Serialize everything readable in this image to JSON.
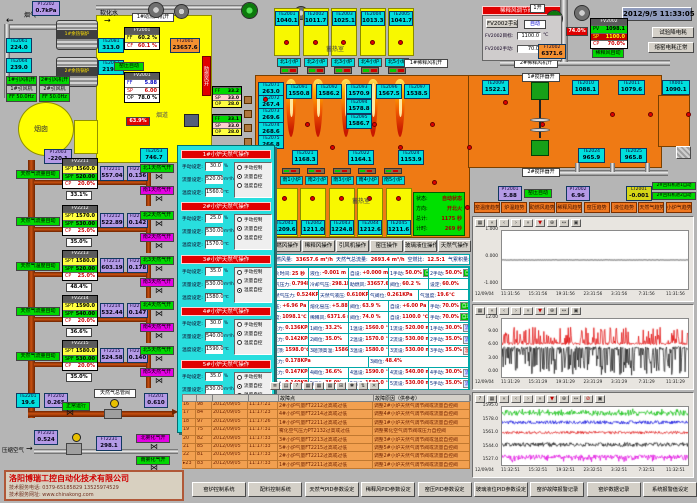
{
  "datetime": "2012/9/5 11:33:05",
  "topLeft": {
    "flueGas": "烟气",
    "softWater": "软化水",
    "duct": "烟道",
    "chimney": "烟囱",
    "airOn": "助燃风开",
    "fanLabel": "1#助燃风机开",
    "kilnAuto": "窑压自动",
    "damper": "63.9%",
    "pt2202": [
      "PT2202",
      "0.7kPa"
    ],
    "pt2003": [
      "PT2003",
      "-220.1"
    ],
    "te2053": [
      "TE2053",
      "746.7"
    ],
    "ft2001": [
      "FT2001",
      "23657.6"
    ],
    "boilers": [
      "1#余热锅炉",
      "2#余热锅炉"
    ],
    "sensors": [
      [
        "TE2061",
        "224.0"
      ],
      [
        "TE2064",
        "239.0"
      ],
      [
        "TE2081",
        "313.0"
      ],
      [
        "TE2063",
        "219.0"
      ]
    ],
    "fanOn": [
      "1#引风机开",
      "2#引风机开"
    ],
    "fans": [
      [
        "1#引风机",
        "FF 50.0Hz"
      ],
      [
        "2#引风机",
        "FF 50.0Hz"
      ]
    ],
    "fy2001": {
      "title": "FY2001",
      "rows": [
        [
          "FF",
          "60.2 %"
        ],
        [
          "CF",
          "60.1 %"
        ]
      ]
    },
    "fv2001": {
      "title": "FV2001",
      "rows": [
        [
          "FF",
          "5.88"
        ],
        [
          "SP",
          "6.00"
        ],
        [
          "OP",
          "78.0 %"
        ]
      ]
    },
    "feeders": [
      {
        "rows": [
          [
            "FF",
            "33.2"
          ],
          [
            "SP",
            "33.0"
          ],
          [
            "OP",
            "28.0"
          ]
        ]
      },
      {
        "rows": [
          [
            "FF",
            "33.1"
          ],
          [
            "SP",
            "33.0"
          ],
          [
            "OP",
            "28.0"
          ]
        ]
      }
    ]
  },
  "regen": {
    "label": "蓄热室",
    "north": [
      [
        "TE2001",
        "1040.1"
      ],
      [
        "TE2002",
        "1011.7"
      ],
      [
        "TE2003",
        "1025.1"
      ],
      [
        "TE2004",
        "1013.3"
      ],
      [
        "TE2005",
        "1041.7"
      ]
    ],
    "burnersN": [
      "北1小炉",
      "北2小炉",
      "北3小炉",
      "北4小炉",
      "北5小炉"
    ],
    "burnersS": [
      "南1小炉",
      "南2小炉",
      "南3小炉",
      "南4小炉",
      "南5小炉"
    ],
    "south": [
      [
        "TE2041",
        "1209.6"
      ],
      [
        "TE2042",
        "1211.0"
      ],
      [
        "TE2043",
        "1224.8"
      ],
      [
        "TE2044",
        "1212.6"
      ],
      [
        "TE2045",
        "1211.6"
      ]
    ]
  },
  "furnace": {
    "leftCol": [
      [
        "TE2071",
        "263.0"
      ],
      [
        "TE2072",
        "267.4"
      ],
      [
        "TE2073",
        "269.6"
      ],
      [
        "TE2074",
        "268.6"
      ],
      [
        "TE2075",
        "266.8"
      ]
    ],
    "topRow": [
      [
        "TE2091",
        "1550.8"
      ],
      [
        "TE2092",
        "1586.2"
      ],
      [
        "TE2093",
        "1570.9"
      ],
      [
        "TE2096",
        "1567.5"
      ],
      [
        "TE2097",
        "1538.5"
      ]
    ],
    "midStack": [
      [
        "TE2094",
        "1578.8"
      ],
      [
        "TE2095",
        "1586.7"
      ]
    ],
    "bottomRow": [
      [
        "TE2021",
        "1168.3"
      ],
      [
        "TE2022",
        "1164.1"
      ],
      [
        "TE2024",
        "1153.9"
      ]
    ],
    "rightTop": [
      [
        "TE2009",
        "1522.1"
      ],
      [
        "TE2010",
        "1088.1"
      ],
      [
        "TE2011",
        "1079.6"
      ],
      [
        "TX001",
        "1090.1"
      ]
    ],
    "rightBottom": [
      [
        "TE2024",
        "965.9"
      ],
      [
        "TE2025",
        "965.8"
      ]
    ],
    "stirrer1": "1#搅拌器开",
    "stirrer2": "2#搅拌器开",
    "fan1": "1#稀释风机开",
    "fan2": "2#稀释风机开",
    "open1": "1开"
  },
  "fire": {
    "button": "开北火",
    "status": [
      [
        "状态:",
        "自动状态"
      ],
      [
        "方向:",
        "开北火"
      ],
      [
        "总计:",
        "1175 秒"
      ],
      [
        "计时:",
        "269 秒"
      ]
    ]
  },
  "opButtons": [
    "助燃风操作",
    "稀释风操作",
    "引风机操作",
    "窑压操作",
    "玻璃液位操作",
    "天然气操作"
  ],
  "dilution": {
    "title": "稀释风调节阀操作",
    "manualBtn": "FV2002手动",
    "autoLabel": "自动",
    "target": {
      "l": "FV2002目标:",
      "v": "1100.0",
      "u": "℃"
    },
    "manual": {
      "l": "FV2002手动:",
      "v": "70.0",
      "u": "%"
    },
    "fv2002": {
      "title": "FV2002",
      "rows": [
        [
          "PV",
          "1098.1"
        ],
        [
          "SP",
          "1100.0"
        ],
        [
          "CP",
          "70.0%"
        ]
      ]
    },
    "autoTag": "稀释风自动",
    "pct": "74.0%",
    "ft2002": [
      "FT2002",
      "6371.6"
    ],
    "btn1": "试验降电耗",
    "btn2": "熔窑电耗正常"
  },
  "gasLoops": [
    {
      "auto": "天然气流量自动",
      "ctrl": "FV2211",
      "spt": "1560.0",
      "spf": "520.00",
      "cp": "20.0%",
      "pos": "33.1%",
      "ft": [
        "FT2211",
        "557.04"
      ],
      "fi": [
        "FI2211",
        "0.136"
      ],
      "vN": "北1天然气开",
      "vS": "南1天然气开"
    },
    {
      "auto": "天然气流量自动",
      "ctrl": "FV2212",
      "spt": "1570.0",
      "spf": "530.00",
      "cp": "25.0%",
      "pos": "35.0%",
      "ft": [
        "FT2212",
        "522.89"
      ],
      "fi": [
        "FI2212",
        "0.142"
      ],
      "vN": "北2天然气开",
      "vS": "南2天然气开"
    },
    {
      "auto": "天然气温度自动",
      "ctrl": "FV2213",
      "spt": "1580.0",
      "spf": "520.00",
      "cp": "25.0%",
      "pos": "48.4%",
      "ft": [
        "FT2213",
        "603.19"
      ],
      "fi": [
        "FI2213",
        "0.178"
      ],
      "vN": "北3天然气开",
      "vS": "南3天然气开"
    },
    {
      "auto": "天然气流量自动",
      "ctrl": "FV2214",
      "spt": "1590.0",
      "spf": "540.00",
      "cp": "20.0%",
      "pos": "36.6%",
      "ft": [
        "FT2214",
        "532.44"
      ],
      "fi": [
        "FI2214",
        "0.147"
      ],
      "vN": "北4天然气开",
      "vS": "南4天然气开"
    },
    {
      "auto": "天然气流量自动",
      "ctrl": "FV2215",
      "spt": "1580.0",
      "spf": "530.00",
      "cp": "20.0%",
      "pos": "35.0%",
      "ft": [
        "FT2215",
        "524.58"
      ],
      "fi": [
        "FI2215",
        "0.140"
      ],
      "vN": "北5天然气开",
      "vS": "南5天然气开"
    }
  ],
  "gasMain": {
    "te": [
      "TE2201",
      "19.6"
    ],
    "pt": [
      "PT2202",
      "0.265"
    ],
    "run": "正常运行",
    "valveLabel": "天然气总管阀",
    "fi": [
      "FI2201",
      "0.610"
    ]
  },
  "airLine": {
    "label": "压缩空气",
    "pt": [
      "PT2321",
      "0.524"
    ],
    "ft": [
      "FT2231",
      "298.1"
    ],
    "vN": "北雾化气开",
    "vS": "南雾化气开"
  },
  "popup": {
    "fieldLabels": [
      "手动设定:",
      "流量设定:",
      "温度设定:"
    ],
    "units": [
      "%",
      "m³/h",
      "℃"
    ],
    "radioLabels": [
      "手动控制",
      "流量自控",
      "温度自控"
    ],
    "sections": [
      {
        "title": "1#小炉天然气操作",
        "manual": "30.0",
        "flow": "520.00",
        "temp": "1560.0",
        "sel": 1
      },
      {
        "title": "2#小炉天然气操作",
        "manual": "25.0",
        "flow": "530.00",
        "temp": "1570.0",
        "sel": 1
      },
      {
        "title": "3#小炉天然气操作",
        "manual": "35.0",
        "flow": "530.00",
        "temp": "1580.0",
        "sel": 2
      },
      {
        "title": "4#小炉天然气操作",
        "manual": "30.0",
        "flow": "540.00",
        "temp": "1590.0",
        "sel": 1
      },
      {
        "title": "5#小炉天然气操作",
        "manual": "35.0",
        "flow": "530.00",
        "temp": "1580.0",
        "sel": 1
      }
    ]
  },
  "statusBar": [
    [
      "助燃风量:",
      "33657.6 m³/h"
    ],
    [
      "天然气总流量:",
      "2693.4 m³/h"
    ],
    [
      "空燃比:",
      "12.5:1"
    ],
    [
      "气累积量:",
      "134057.7m³"
    ]
  ],
  "midTable": [
    {
      "cells": [
        {
          "l": "换火时间:",
          "v": "25 秒"
        },
        {
          "l": "液位:",
          "v": "-0.001 m"
        },
        {
          "l": "自设:",
          "v": "+0.000 m"
        },
        {
          "l": "1手动:",
          "v": "50.0%",
          "b": "自动"
        },
        {
          "l": "2手动:",
          "v": "50.0%",
          "b": "自动"
        }
      ]
    },
    {
      "cells": [
        {
          "l": "煤气压力:",
          "v": "0.794KPa"
        },
        {
          "l": "冷却气压:",
          "v": "298.1KPa"
        },
        {
          "l": "助燃风:",
          "v": "33657.6 m³/h"
        },
        {
          "l": "阀位:",
          "v": "60.2 %"
        },
        {
          "l": "设定:",
          "v": "60.0%"
        }
      ]
    },
    {
      "cells": [
        {
          "l": "天然气压力:",
          "v": "0.524KPa"
        },
        {
          "l": "天然气液压:",
          "v": "0.610KPa"
        },
        {
          "l": "气阀位:",
          "v": "0.261KPa"
        },
        {
          "l": "气温度:",
          "v": "19.6℃"
        }
      ]
    },
    {
      "cells": [
        {
          "l": "窑压:",
          "v": "+6.96 Pa"
        },
        {
          "l": "熔化窑压:",
          "v": "+5.88 Pa"
        },
        {
          "l": "阀位:",
          "v": "63.9 %"
        },
        {
          "l": "自设:",
          "v": "+6.00 Pa"
        },
        {
          "l": "手动:",
          "v": "70.0%",
          "b": "自动"
        }
      ]
    },
    {
      "cells": [
        {
          "l": "温度:",
          "v": "1098.1℃"
        },
        {
          "l": "稀释风:",
          "v": "6371.6 m³/h"
        },
        {
          "l": "阀位:",
          "v": "74.0 %"
        },
        {
          "l": "自设:",
          "v": "1100.0 ℃"
        },
        {
          "l": "手动:",
          "v": "70.0%",
          "b": "自动"
        }
      ]
    },
    {
      "cells": [
        {
          "l": "1压力:",
          "v": "0.136KPa"
        },
        {
          "l": "1阀位:",
          "v": "33.2%"
        },
        {
          "l": "1温设:",
          "v": "1560.0 ℃"
        },
        {
          "l": "1流设:",
          "v": "520.00 m³/h"
        },
        {
          "l": "1手动:",
          "v": "30.0%",
          "b": "流控"
        }
      ]
    },
    {
      "cells": [
        {
          "l": "2压力:",
          "v": "0.142KPa"
        },
        {
          "l": "2阀位:",
          "v": "35.0%"
        },
        {
          "l": "2温设:",
          "v": "1570.0 ℃"
        },
        {
          "l": "2流设:",
          "v": "530.00 m³/h"
        },
        {
          "l": "2手动:",
          "v": "35.0%",
          "b": "流控"
        }
      ]
    },
    {
      "cells": [
        {
          "l": "3碹顶:",
          "v": "1598.0℃"
        },
        {
          "l": "3碹顶高温:",
          "v": "1586.7℃"
        },
        {
          "l": "3温设:",
          "v": "1580.0 ℃"
        },
        {
          "l": "3流设:",
          "v": "530.00 m³/h"
        },
        {
          "l": "3手动:",
          "v": "35.0%",
          "b": "温控"
        }
      ]
    },
    {
      "cells": [
        {
          "l": "3压力:",
          "v": "0.178KPa"
        },
        {
          "l": "3阀位:",
          "v": "48.4%"
        }
      ]
    },
    {
      "cells": [
        {
          "l": "4压力:",
          "v": "0.147KPa"
        },
        {
          "l": "4阀位:",
          "v": "36.6%"
        },
        {
          "l": "4温设:",
          "v": "1590.0 ℃"
        },
        {
          "l": "4流设:",
          "v": "540.00 m³/h"
        },
        {
          "l": "4手动:",
          "v": "30.0%",
          "b": "流控"
        }
      ]
    },
    {
      "cells": [
        {
          "l": "5压力:",
          "v": "0.140KPa"
        },
        {
          "l": "5阀位:",
          "v": "35.0%"
        },
        {
          "l": "5温设:",
          "v": "1580.0 ℃"
        },
        {
          "l": "5流设:",
          "v": "530.00 m³/h"
        },
        {
          "l": "5手动:",
          "v": "35.0%",
          "b": "流控"
        }
      ]
    }
  ],
  "kilnBoxes": {
    "pt2001": [
      "PT2001",
      "5.88"
    ],
    "auto": "窑压自动",
    "pt2002": [
      "PT2002",
      "6.96"
    ],
    "lt2001": [
      "LT2001",
      "-0.001"
    ],
    "feed": [
      "2#回料机进1自动",
      "2#回料机进2自动"
    ]
  },
  "trendButtons": [
    "窑温度趋势",
    "炉温趋势",
    "助燃风趋势",
    "稀释风趋势",
    "窑压趋势",
    "液位趋势",
    "天然气趋势",
    "小炉气趋势"
  ],
  "chart_data": [
    {
      "type": "line",
      "yLabels": [
        "1.000",
        "0.000",
        "-1.000"
      ],
      "ymin": -1,
      "ymax": 1,
      "xDate": "12/09/04",
      "xLabels": [
        "11:31:56",
        "15:31:56",
        "19:31:56",
        "23:31:56",
        "3:31:56",
        "7:31:56",
        "11:31:56"
      ],
      "toolbar": [
        "▦",
        "«",
        "‹",
        "›",
        "»",
        "▼",
        "⊕",
        "↔",
        "▣"
      ],
      "series": [
        {
          "name": "玻璃液位",
          "color": "#000000",
          "base": 0,
          "noise": 0.006,
          "spikeUp": 0,
          "spikeDn": 0,
          "spikeP": 0
        }
      ]
    },
    {
      "type": "line",
      "yLabels": [
        "12.00",
        "9.00",
        "6.00",
        "3.00",
        "0.00"
      ],
      "ymin": 0,
      "ymax": 12,
      "xDate": "12/09/04",
      "xLabels": [
        "11:31:29",
        "15:31:29",
        "19:31:29",
        "23:31:29",
        "3:31:29",
        "7:31:29",
        "11:31:29"
      ],
      "toolbar": [
        "▦",
        "«",
        "‹",
        "›",
        "»",
        "▼",
        "⊕",
        "↔",
        "▣"
      ],
      "series": [
        {
          "name": "窑压测量",
          "color": "#1a1a1a",
          "base": 6.0,
          "noise": 0.3,
          "spikeUp": 0,
          "spikeDn": 5.5,
          "spikeP": 0.5
        },
        {
          "name": "窑压上限",
          "color": "#e00000",
          "base": 6.9,
          "noise": 0.25,
          "spikeUp": 3.4,
          "spikeDn": 0,
          "spikeP": 0.4
        }
      ]
    },
    {
      "type": "line",
      "yLabels": [
        "1595.0",
        "1578.0",
        "1561.0",
        "1544.0",
        "1527.0"
      ],
      "ymin": 1527,
      "ymax": 1595,
      "xDate": "12/09/04",
      "xLabels": [
        "11:32:51",
        "15:32:51",
        "19:32:51",
        "23:32:51",
        "3:32:51",
        "7:32:51",
        "11:32:51"
      ],
      "toolbar": [
        "?",
        "▦",
        "«",
        "‹",
        "›",
        "»",
        "▼",
        "⊕",
        "↔",
        "⊘",
        "▣"
      ],
      "series": [
        {
          "name": "1#小炉温度",
          "color": "#00bc00",
          "base": 1587,
          "noise": 2.2,
          "spikeUp": 4,
          "spikeDn": 0,
          "spikeP": 0.45
        },
        {
          "name": "2#小炉温度",
          "color": "#0000dc",
          "base": 1577,
          "noise": 2.0,
          "spikeUp": 0,
          "spikeDn": 0,
          "spikeP": 0
        },
        {
          "name": "3#小炉温度",
          "color": "#dc0000",
          "base": 1565,
          "noise": 1.6,
          "spikeUp": 0,
          "spikeDn": 0,
          "spikeP": 0
        },
        {
          "name": "4#小炉温度",
          "color": "#111111",
          "base": 1551,
          "noise": 2.4,
          "spikeUp": 0,
          "spikeDn": 0,
          "spikeP": 0
        },
        {
          "name": "5#小炉温度",
          "color": "#e000e0",
          "base": 1537,
          "noise": 2.0,
          "spikeUp": 0,
          "spikeDn": 5,
          "spikeP": 0.4
        }
      ]
    }
  ],
  "alarm": {
    "toolbar": [
      "≣",
      "▤",
      "?",
      "▦",
      "▦",
      "▦",
      "⊞",
      "✱",
      "⇅",
      "✕"
    ],
    "headers": [
      "",
      "",
      "",
      "",
      "故障点",
      "故障原因（供参考）"
    ],
    "rows": [
      [
        "16",
        "98",
        "2012/09/05",
        "11:17:21",
        "2#小炉气量FT2212过高或过低",
        "调整2#小炉天然气调节阀或流量自控阀"
      ],
      [
        "17",
        "84",
        "2012/09/05",
        "11:17:23",
        "4#小炉气量FT2214过高或过低",
        "调整4#小炉天然气调节阀或流量自控阀"
      ],
      [
        "18",
        "97",
        "2012/09/05",
        "11:17:26",
        "1#小炉气量FT2211过高或过低",
        "调整1#小炉天然气调节阀或流量自控阀"
      ],
      [
        "19",
        "75",
        "2012/09/05",
        "11:17:31",
        "雾化空气压力PT2132过高或过低",
        "调整雾化空气调节阀或压力自控阀"
      ],
      [
        "20",
        "82",
        "2012/09/05",
        "11:17:33",
        "3#小炉气量FT2213过高或过低",
        "调整3#小炉天然气调节阀或温度自控阀"
      ],
      [
        "21",
        "85",
        "2012/09/05",
        "11:17:33",
        "5#小炉气量FT2215过高或过低",
        "调整5#小炉天然气调节阀或流量自控阀"
      ],
      [
        "22",
        "81",
        "2012/09/05",
        "11:17:33",
        "2#小炉气量FT2212过高或过低",
        "调整2#小炉天然气调节阀或流量自控阀"
      ],
      [
        "23",
        "83",
        "2012/09/05",
        "11:17:33",
        "1#小炉气量FT2211过高或过低",
        "调整1#小炉天然气调节阀或流量自控阀"
      ]
    ]
  },
  "bottomButtons": [
    "窑炉控制系统",
    "配料控制系统",
    "天然气PID参数设定",
    "稀释风PID参数设定",
    "窑压PID参数设定",
    "玻璃液位PID参数设定",
    "窑炉故障报警记录",
    "窑炉数据记录",
    "系统报警值设定"
  ],
  "company": {
    "name": "洛阳博瑞工控自动化技术有限公司",
    "phone": "技术服务电话: 0379-65185829  13525974529",
    "web": "技术服务网址: www.chinakong.com"
  },
  "colors": {
    "furnace": "#ef7a14",
    "chamber": "#f8f800",
    "popup": "#28dede",
    "alarmRow": "#f2a050"
  }
}
